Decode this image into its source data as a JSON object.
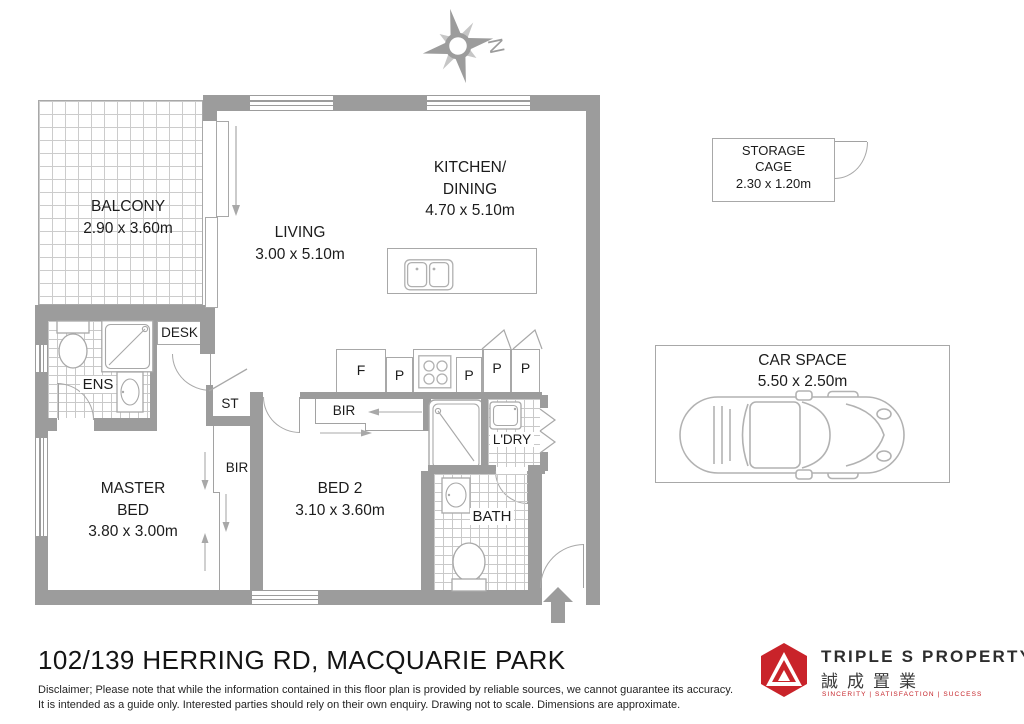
{
  "compass": {
    "north": "N"
  },
  "rooms": {
    "balcony": {
      "name": "BALCONY",
      "dims": "2.90 x 3.60m"
    },
    "living": {
      "name": "LIVING",
      "dims": "3.00 x 5.10m"
    },
    "kitchen_dining": {
      "name_line1": "KITCHEN/",
      "name_line2": "DINING",
      "dims": "4.70 x 5.10m"
    },
    "master_bed": {
      "name_line1": "MASTER",
      "name_line2": "BED",
      "dims": "3.80 x 3.00m"
    },
    "bed2": {
      "name": "BED 2",
      "dims": "3.10 x 3.60m"
    },
    "ensuite": {
      "name": "ENS"
    },
    "bath": {
      "name": "BATH"
    },
    "laundry": {
      "name": "L'DRY"
    },
    "storage_closet": {
      "name": "ST"
    },
    "built_in_robe": {
      "name": "BIR"
    },
    "desk": {
      "name": "DESK"
    }
  },
  "kitchen_fixtures": {
    "fridge": "F",
    "pantry": "P"
  },
  "outdoor": {
    "storage_cage": {
      "name_line1": "STORAGE",
      "name_line2": "CAGE",
      "dims": "2.30 x 1.20m"
    },
    "car_space": {
      "name": "CAR SPACE",
      "dims": "5.50 x 2.50m"
    }
  },
  "footer": {
    "address": "102/139 HERRING RD, MACQUARIE PARK",
    "disclaimer_line1": "Disclaimer; Please note that while the information contained in this floor plan is provided by reliable sources, we cannot guarantee its accuracy.",
    "disclaimer_line2": "It is intended as a guide only. Interested parties should rely on their own enquiry. Drawing not to scale.  Dimensions are approximate."
  },
  "brand": {
    "name": "TRIPLE S PROPERTY",
    "chinese_name": "誠成置業",
    "tagline": "SINCERITY  |  SATISFACTION  |  SUCCESS",
    "accent_color": "#c42127"
  },
  "colors": {
    "wall": "#9c9c9c",
    "line": "#a8a8a8",
    "tile": "#cccccc",
    "text": "#1c1c1c"
  }
}
